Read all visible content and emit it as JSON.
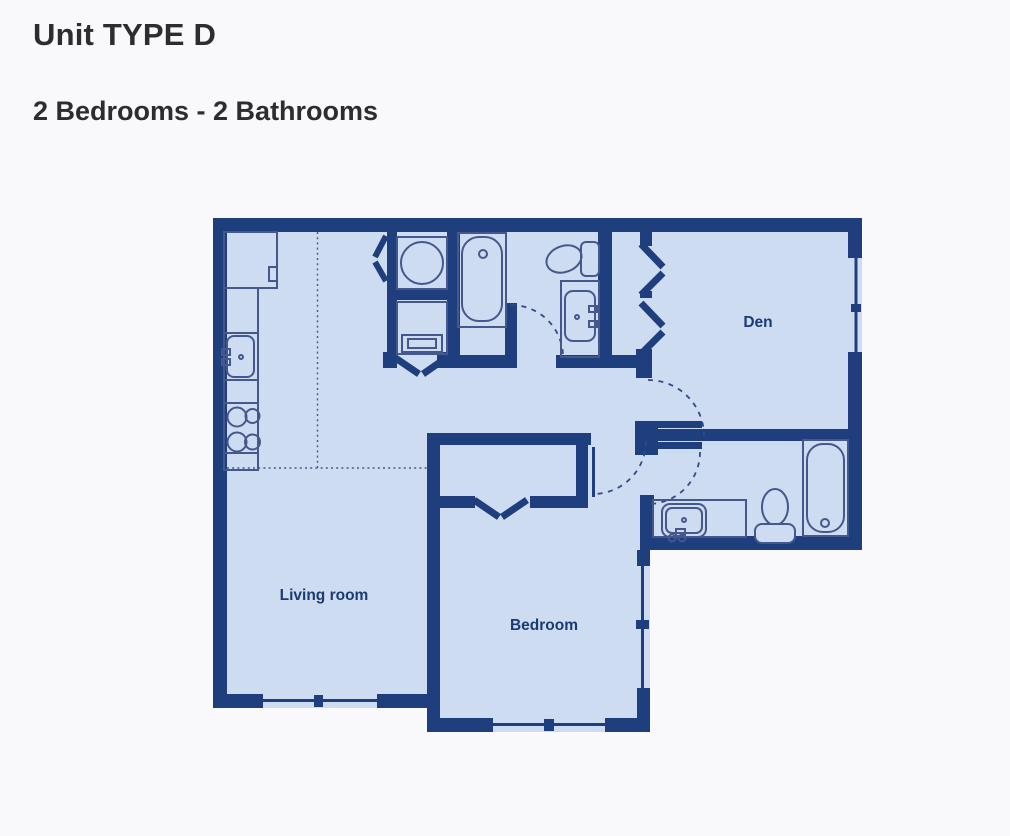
{
  "header": {
    "title": "Unit TYPE D",
    "subtitle": "2 Bedrooms - 2 Bathrooms"
  },
  "rooms": {
    "den": "Den",
    "living_room": "Living room",
    "bedroom": "Bedroom"
  },
  "fixtures": [
    "refrigerator",
    "kitchen-counter",
    "kitchen-sink",
    "stove",
    "washer",
    "dryer",
    "main-bathtub",
    "main-toilet",
    "main-vanity-sink",
    "ensuite-vanity-sink",
    "ensuite-toilet",
    "ensuite-bathtub"
  ],
  "colors": {
    "page-bg": "#f9f9fb",
    "wall-color": "#1f3e7e",
    "floor-color": "#cedcf1",
    "fixture-color": "#44588e",
    "label-color": "#1a3a74",
    "swing-color": "#2d4c8c",
    "dotted-color": "#44598e",
    "title-color": "#2b2d31"
  }
}
